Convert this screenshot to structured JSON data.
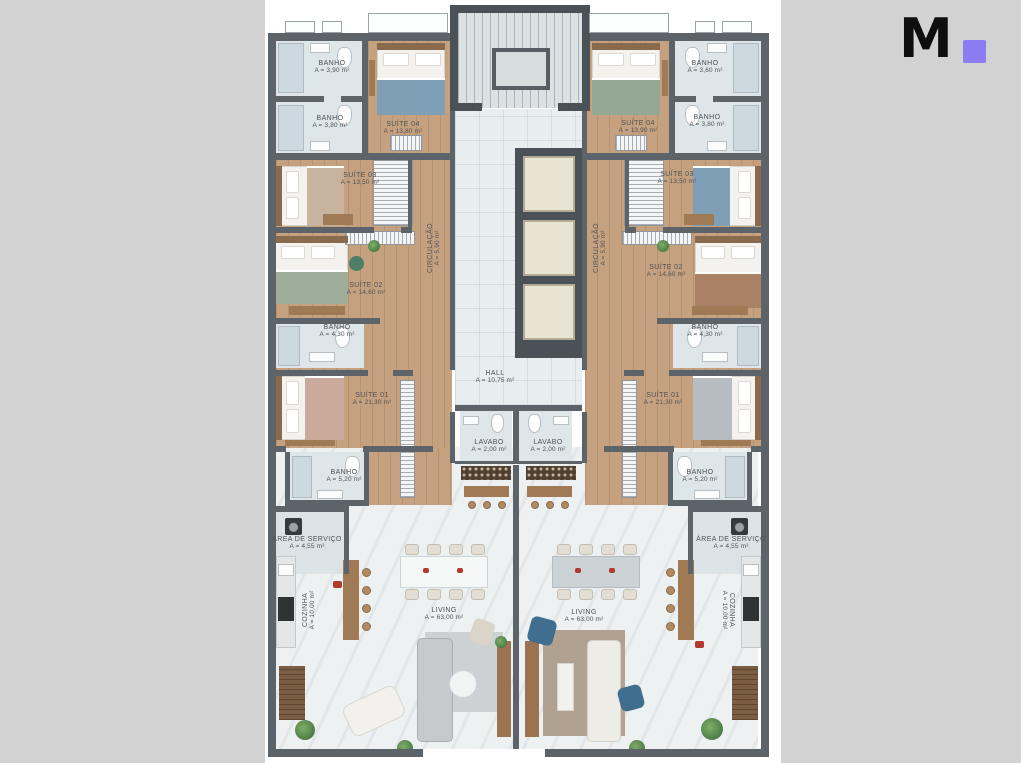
{
  "page": {
    "background": "#d2d2d2",
    "sheet_background": "#ffffff"
  },
  "logo": {
    "letter": "M",
    "letter_color": "#0e0e0e",
    "square_color": "#8d7bf2"
  },
  "plan": {
    "wall_color": "#5c6369",
    "wood_floor_color": "#c5a180",
    "bath_floor_color": "#dee6ea",
    "living_floor_color": "#eef1f2"
  },
  "labels": [
    {
      "id": "banho-1-left",
      "name": "BANHO",
      "area": "A = 3,90 m²",
      "x": 67,
      "y": 67,
      "rot": 0
    },
    {
      "id": "banho-2-left",
      "name": "BANHO",
      "area": "A = 3,80 m²",
      "x": 65,
      "y": 122,
      "rot": 0
    },
    {
      "id": "suite-04-left",
      "name": "SUÍTE 04",
      "area": "A = 13,80 m²",
      "x": 138,
      "y": 128,
      "rot": 0
    },
    {
      "id": "suite-03-left",
      "name": "SUÍTE 03",
      "area": "A = 13,50 m²",
      "x": 95,
      "y": 179,
      "rot": 0
    },
    {
      "id": "circulacao-left",
      "name": "CIRCULAÇÃO",
      "area": "A = 5,90 m²",
      "x": 169,
      "y": 248,
      "rot": -90
    },
    {
      "id": "suite-02-left",
      "name": "SUÍTE 02",
      "area": "A = 14,60 m²",
      "x": 101,
      "y": 289,
      "rot": 0
    },
    {
      "id": "banho-3-left",
      "name": "BANHO",
      "area": "A = 4,30 m²",
      "x": 72,
      "y": 331,
      "rot": 0
    },
    {
      "id": "suite-01-left",
      "name": "SUÍTE 01",
      "area": "A = 21,30 m²",
      "x": 107,
      "y": 399,
      "rot": 0
    },
    {
      "id": "banho-4-left",
      "name": "BANHO",
      "area": "A = 5,20 m²",
      "x": 79,
      "y": 476,
      "rot": 0
    },
    {
      "id": "area-servico-left",
      "name": "ÁREA DE SERVIÇO",
      "area": "A = 4,55 m²",
      "x": 42,
      "y": 543,
      "rot": 0
    },
    {
      "id": "cozinha-left",
      "name": "COZINHA",
      "area": "A = 10,00 m²",
      "x": 44,
      "y": 610,
      "rot": -90
    },
    {
      "id": "living-left",
      "name": "LIVING",
      "area": "A = 63,00 m²",
      "x": 179,
      "y": 614,
      "rot": 0
    },
    {
      "id": "hall",
      "name": "HALL",
      "area": "A = 10,75 m²",
      "x": 230,
      "y": 377,
      "rot": 0
    },
    {
      "id": "lavabo-left",
      "name": "LAVABO",
      "area": "A = 2,00 m²",
      "x": 224,
      "y": 446,
      "rot": 0
    },
    {
      "id": "lavabo-right",
      "name": "LAVABO",
      "area": "A = 2,00 m²",
      "x": 283,
      "y": 446,
      "rot": 0
    },
    {
      "id": "suite-04-right",
      "name": "SUÍTE 04",
      "area": "A = 13,90 m²",
      "x": 373,
      "y": 127,
      "rot": 0
    },
    {
      "id": "banho-1-right",
      "name": "BANHO",
      "area": "A = 3,60 m²",
      "x": 440,
      "y": 67,
      "rot": 0
    },
    {
      "id": "banho-2-right",
      "name": "BANHO",
      "area": "A = 3,80 m²",
      "x": 442,
      "y": 121,
      "rot": 0
    },
    {
      "id": "suite-03-right",
      "name": "SUÍTE 03",
      "area": "A = 13,50 m²",
      "x": 412,
      "y": 178,
      "rot": 0
    },
    {
      "id": "circulacao-right",
      "name": "CIRCULAÇÃO",
      "area": "A = 5,90 m²",
      "x": 335,
      "y": 248,
      "rot": -90
    },
    {
      "id": "suite-02-right",
      "name": "SUÍTE 02",
      "area": "A = 14,60 m²",
      "x": 401,
      "y": 271,
      "rot": 0
    },
    {
      "id": "banho-3-right",
      "name": "BANHO",
      "area": "A = 4,30 m²",
      "x": 440,
      "y": 331,
      "rot": 0
    },
    {
      "id": "suite-01-right",
      "name": "SUÍTE 01",
      "area": "A = 21,30 m²",
      "x": 398,
      "y": 399,
      "rot": 0
    },
    {
      "id": "banho-4-right",
      "name": "BANHO",
      "area": "A = 5,20 m²",
      "x": 435,
      "y": 476,
      "rot": 0
    },
    {
      "id": "area-servico-right",
      "name": "ÁREA DE SERVIÇO",
      "area": "A = 4,55 m²",
      "x": 466,
      "y": 543,
      "rot": 0
    },
    {
      "id": "cozinha-right",
      "name": "COZINHA",
      "area": "A = 10,00 m²",
      "x": 463,
      "y": 610,
      "rot": 90
    },
    {
      "id": "living-right",
      "name": "LIVING",
      "area": "A = 63,00 m²",
      "x": 319,
      "y": 616,
      "rot": 0
    }
  ]
}
